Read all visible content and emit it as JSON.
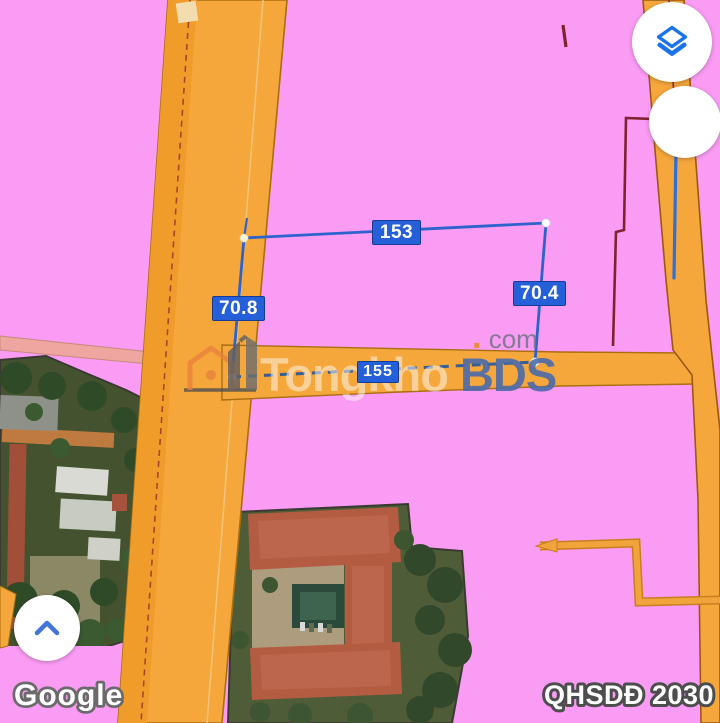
{
  "measurements": {
    "top": "153",
    "right": "70.4",
    "left": "70.8",
    "bottom": "155"
  },
  "watermark": {
    "brand_part1": "Tongkho",
    "brand_part2": "BDS",
    "dot": ".",
    "tld": "com"
  },
  "attribution": {
    "text": "Google"
  },
  "plan_badge": {
    "text": "QHSDĐ 2030"
  },
  "controls": {
    "layers_button": {
      "icon": "layers-icon"
    },
    "secondary_button": {
      "icon": "blank-circle"
    },
    "expand_button": {
      "icon": "chevron-up-icon"
    }
  },
  "colors": {
    "zone_pink": "#FA9BF4",
    "road_orange": "#F5A73C",
    "road_border": "#A96F10",
    "salmon_road": "#EFA6A0",
    "boundary_maroon": "#7E2230",
    "measure_blue": "#2E63CC",
    "measure_dash_blue": "#3A5E93",
    "label_bg": "#2560D8",
    "accent_blue": "#1A73E8"
  }
}
